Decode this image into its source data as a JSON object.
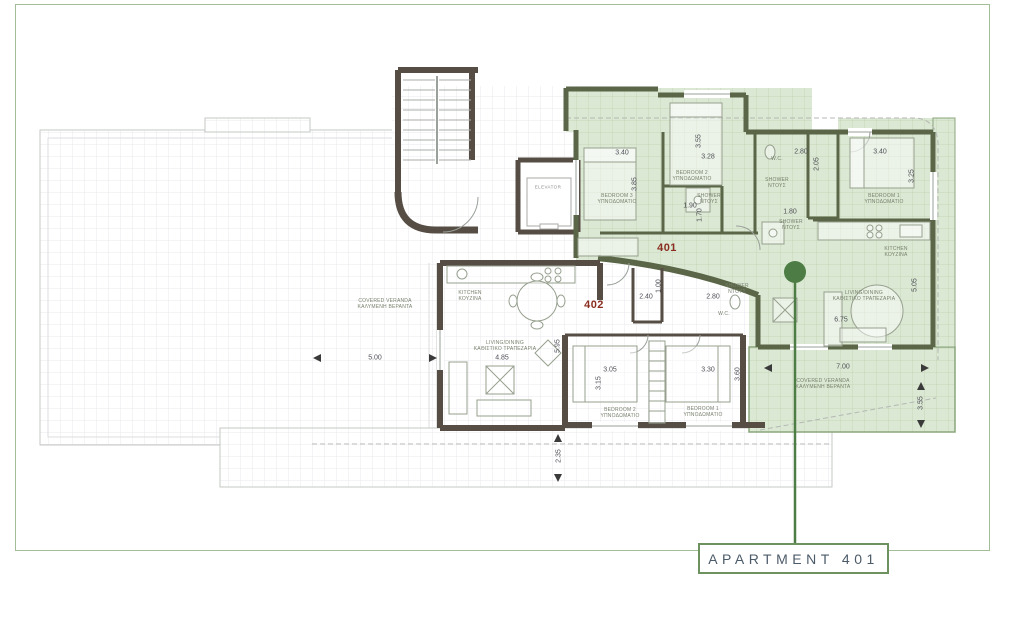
{
  "callout": {
    "label": "APARTMENT 401"
  },
  "colors": {
    "highlight_green": "#dbe8d3",
    "grid_green_line": "#c6d6b8",
    "grid_gray_line": "#e8e8ec",
    "wall_olive": "#5a6647",
    "wall_brown": "#564e44",
    "frame_green": "#a3bd97",
    "accent_green": "#4d7c44",
    "apartment_number_red": "#8a2d20"
  },
  "plan": {
    "apartment_labels": [
      {
        "text": "401",
        "x": 667,
        "y": 248
      },
      {
        "text": "402",
        "x": 594,
        "y": 305
      }
    ],
    "room_labels": [
      {
        "line1": "BEDROOM 3",
        "line2": "ΥΠΝΟΔΩΜΑΤΙΟ",
        "x": 617,
        "y": 199
      },
      {
        "line1": "BEDROOM 2",
        "line2": "ΥΠΝΟΔΩΜΑΤΙΟ",
        "x": 692,
        "y": 176
      },
      {
        "line1": "BEDROOM 1",
        "line2": "ΥΠΝΟΔΩΜΑΤΙΟ",
        "x": 884,
        "y": 199
      },
      {
        "line1": "W.C.",
        "line2": "",
        "x": 777,
        "y": 159
      },
      {
        "line1": "SHOWER",
        "line2": "ΝΤΟΥΣ",
        "x": 777,
        "y": 183
      },
      {
        "line1": "SHOWER",
        "line2": "ΝΤΟΥΣ",
        "x": 709,
        "y": 199
      },
      {
        "line1": "SHOWER",
        "line2": "ΝΤΟΥΣ",
        "x": 791,
        "y": 225
      },
      {
        "line1": "KITCHEN",
        "line2": "ΚΟΥΖΙΝΑ",
        "x": 896,
        "y": 252
      },
      {
        "line1": "LIVING/DINING",
        "line2": "ΚΑΘΙΣΤΙΚΟ ΤΡΑΠΕΖΑΡΙΑ",
        "x": 864,
        "y": 296
      },
      {
        "line1": "COVERED VERANDA",
        "line2": "ΚΑΛΥΜΕΝΗ ΒΕΡΑΝΤΑ",
        "x": 823,
        "y": 384
      },
      {
        "line1": "KITCHEN",
        "line2": "ΚΟΥΖΙΝΑ",
        "x": 470,
        "y": 296
      },
      {
        "line1": "LIVING/DINING",
        "line2": "ΚΑΘΙΣΤΙΚΟ ΤΡΑΠΕΖΑΡΙΑ",
        "x": 505,
        "y": 346
      },
      {
        "line1": "SHOWER",
        "line2": "ΝΤΟΥΣ",
        "x": 737,
        "y": 289
      },
      {
        "line1": "W.C.",
        "line2": "",
        "x": 724,
        "y": 314
      },
      {
        "line1": "BEDROOM 2",
        "line2": "ΥΠΝΟΔΩΜΑΤΙΟ",
        "x": 620,
        "y": 413
      },
      {
        "line1": "BEDROOM 1",
        "line2": "ΥΠΝΟΔΩΜΑΤΙΟ",
        "x": 703,
        "y": 412
      },
      {
        "line1": "COVERED VERANDA",
        "line2": "ΚΑΛΥΜΕΝΗ ΒΕΡΑΝΤΑ",
        "x": 385,
        "y": 304
      }
    ],
    "dimensions": [
      {
        "v": "3.40",
        "x": 622,
        "y": 153,
        "rot": 0
      },
      {
        "v": "3.85",
        "x": 635,
        "y": 184,
        "rot": 1
      },
      {
        "v": "3.55",
        "x": 699,
        "y": 141,
        "rot": 1
      },
      {
        "v": "3.28",
        "x": 708,
        "y": 157,
        "rot": 0
      },
      {
        "v": "1.90",
        "x": 690,
        "y": 206,
        "rot": 0
      },
      {
        "v": "1.70",
        "x": 700,
        "y": 215,
        "rot": 1
      },
      {
        "v": "2.80",
        "x": 801,
        "y": 152,
        "rot": 0
      },
      {
        "v": "2.05",
        "x": 817,
        "y": 164,
        "rot": 1
      },
      {
        "v": "3.40",
        "x": 880,
        "y": 152,
        "rot": 0
      },
      {
        "v": "3.25",
        "x": 912,
        "y": 176,
        "rot": 1
      },
      {
        "v": "1.80",
        "x": 790,
        "y": 212,
        "rot": 0
      },
      {
        "v": "2.40",
        "x": 646,
        "y": 297,
        "rot": 0
      },
      {
        "v": "1.00",
        "x": 659,
        "y": 286,
        "rot": 1
      },
      {
        "v": "2.80",
        "x": 713,
        "y": 297,
        "rot": 0
      },
      {
        "v": "6.75",
        "x": 841,
        "y": 320,
        "rot": 0
      },
      {
        "v": "5.05",
        "x": 915,
        "y": 285,
        "rot": 1
      },
      {
        "v": "7.00",
        "x": 843,
        "y": 367,
        "rot": 0
      },
      {
        "v": "3.55",
        "x": 921,
        "y": 403,
        "rot": 1
      },
      {
        "v": "4.85",
        "x": 502,
        "y": 358,
        "rot": 0
      },
      {
        "v": "5.95",
        "x": 558,
        "y": 346,
        "rot": 1
      },
      {
        "v": "3.05",
        "x": 610,
        "y": 370,
        "rot": 0
      },
      {
        "v": "3.15",
        "x": 599,
        "y": 383,
        "rot": 1
      },
      {
        "v": "3.30",
        "x": 708,
        "y": 370,
        "rot": 0
      },
      {
        "v": "3.60",
        "x": 738,
        "y": 374,
        "rot": 1
      },
      {
        "v": "5.00",
        "x": 375,
        "y": 358,
        "rot": 0
      },
      {
        "v": "2.35",
        "x": 559,
        "y": 456,
        "rot": 1
      }
    ],
    "misc_labels": [
      {
        "text": "ELEVATOR",
        "x": 548,
        "y": 187
      }
    ]
  }
}
